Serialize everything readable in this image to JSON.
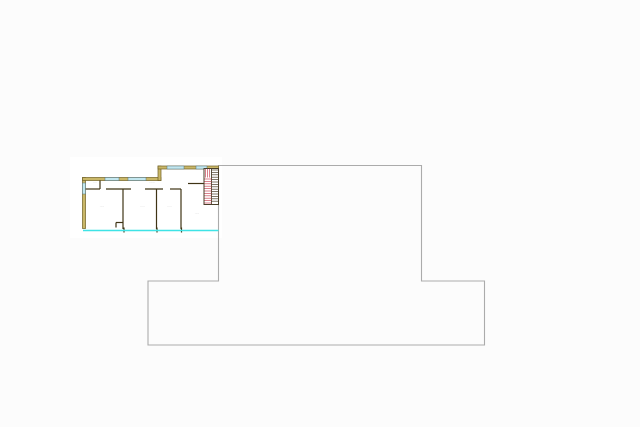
{
  "canvas": {
    "width": 640,
    "height": 427,
    "background": "#fcfcfc",
    "paper": {
      "x": 70,
      "y": 157,
      "w": 152,
      "h": 81,
      "fill": "#ffffff"
    }
  },
  "palette": {
    "wall_fill": "#c9b768",
    "wall_edge": "#6f5f22",
    "window_fill": "#c2e7ef",
    "window_edge": "#53707d",
    "interior": "#3f3415",
    "stair_red": "#c94a5a",
    "stair_dark": "#4a3f2a",
    "facade": "#3fe3e6",
    "outline": "#ababab",
    "label": "#9b9b9b"
  },
  "floorplan": {
    "outer_walls": [
      {
        "name": "wall-left",
        "x": 82.5,
        "y": 177.5,
        "w": 3,
        "h": 51
      },
      {
        "name": "wall-top-left",
        "x": 82.5,
        "y": 177.5,
        "w": 78.5,
        "h": 3
      },
      {
        "name": "wall-step",
        "x": 158,
        "y": 166,
        "w": 3,
        "h": 14.5
      },
      {
        "name": "wall-top-right",
        "x": 158,
        "y": 166,
        "w": 60.5,
        "h": 3
      }
    ],
    "windows": [
      {
        "name": "window-left",
        "x": 82.5,
        "y": 183,
        "w": 3,
        "h": 11
      },
      {
        "name": "window-top-1",
        "x": 105,
        "y": 177.5,
        "w": 14,
        "h": 3
      },
      {
        "name": "window-top-2",
        "x": 128,
        "y": 177.5,
        "w": 18,
        "h": 3
      },
      {
        "name": "window-top-3",
        "x": 167,
        "y": 166,
        "w": 17,
        "h": 3
      },
      {
        "name": "window-top-4",
        "x": 196,
        "y": 166,
        "w": 11,
        "h": 3
      }
    ],
    "interior_walls": [
      {
        "name": "partition-h-1",
        "x1": 85.5,
        "y1": 189,
        "x2": 100,
        "y2": 189
      },
      {
        "name": "partition-h-2",
        "x1": 106,
        "y1": 189,
        "x2": 131,
        "y2": 189
      },
      {
        "name": "partition-h-3",
        "x1": 145,
        "y1": 189,
        "x2": 163,
        "y2": 189
      },
      {
        "name": "partition-h-4",
        "x1": 170,
        "y1": 189,
        "x2": 181,
        "y2": 189
      },
      {
        "name": "partition-stub",
        "x1": 100,
        "y1": 180.5,
        "x2": 100,
        "y2": 189
      },
      {
        "name": "room-divider-1",
        "x1": 123,
        "y1": 189,
        "x2": 123,
        "y2": 229
      },
      {
        "name": "room-divider-2",
        "x1": 156.5,
        "y1": 189,
        "x2": 156.5,
        "y2": 229
      },
      {
        "name": "room-divider-3",
        "x1": 181,
        "y1": 189,
        "x2": 181,
        "y2": 229
      },
      {
        "name": "door-jamb-h",
        "x1": 116,
        "y1": 222.5,
        "x2": 123,
        "y2": 222.5
      },
      {
        "name": "door-jamb-v",
        "x1": 116,
        "y1": 222.5,
        "x2": 116,
        "y2": 227.5
      },
      {
        "name": "stair-access-wall",
        "x1": 188,
        "y1": 183.5,
        "x2": 204,
        "y2": 183.5
      },
      {
        "name": "facade-tick-1",
        "x1": 124,
        "y1": 227.5,
        "x2": 124,
        "y2": 232.5
      },
      {
        "name": "facade-tick-2",
        "x1": 157,
        "y1": 227.5,
        "x2": 157,
        "y2": 232.5
      },
      {
        "name": "facade-tick-3",
        "x1": 181.5,
        "y1": 227.5,
        "x2": 181.5,
        "y2": 232.5
      }
    ],
    "stair": {
      "x": 204,
      "y": 168.5,
      "w": 14.5,
      "h": 36,
      "mid": 211.5,
      "tread_spacing": 2.4,
      "winder_h": 9
    },
    "facade_line": {
      "x1": 83,
      "y1": 230.5,
      "x2": 218.5,
      "y2": 230.5,
      "width": 1.6
    },
    "labels": [
      {
        "name": "label-room-small",
        "text": "····",
        "x": 95,
        "y": 183.5
      },
      {
        "name": "label-hall",
        "text": "·······",
        "x": 152,
        "y": 183
      },
      {
        "name": "label-room-1",
        "text": "·····",
        "x": 102,
        "y": 207.5
      },
      {
        "name": "label-room-2",
        "text": "·····",
        "x": 142.5,
        "y": 207.5
      },
      {
        "name": "label-room-3",
        "text": "·····",
        "x": 169.5,
        "y": 207.5
      },
      {
        "name": "label-room-4",
        "text": "·····",
        "x": 197,
        "y": 214.5
      }
    ]
  },
  "building_outline": {
    "points": "218.5,165.5 421.5,165.5 421.5,281 484.5,281 484.5,345 148,345 148,281 218.5,281"
  }
}
